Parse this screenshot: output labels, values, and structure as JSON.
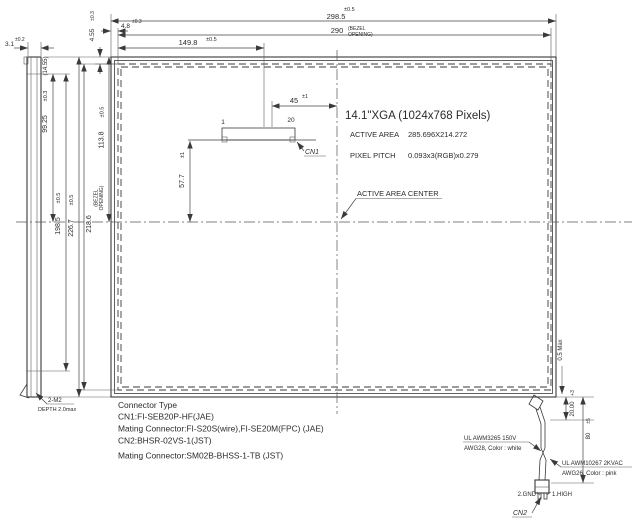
{
  "drawing": {
    "spec": {
      "title": "14.1\"XGA (1024x768 Pixels)",
      "active_area_label": "ACTIVE AREA",
      "active_area_value": "285.696X214.272",
      "pixel_pitch_label": "PIXEL PITCH",
      "pixel_pitch_value": "0.093x3(RGB)x0.279",
      "active_area_center_label": "ACTIVE AREA CENTER"
    },
    "dims": {
      "total_width": {
        "value": "298.5",
        "tol": "±0.5"
      },
      "bezel_width": {
        "value": "290",
        "note1": "(BEZEL",
        "note2": "OPENING)"
      },
      "cn1_offset_x": {
        "value": "149.8",
        "tol": "±0.5"
      },
      "bezel_margin_left": {
        "value": "4.8",
        "tol": "±0.3"
      },
      "bezel_margin_top": {
        "value": "4.55",
        "tol": "±0.3"
      },
      "side_thickness": {
        "value": "3.1",
        "tol": "±0.2"
      },
      "side_thickness_ref": {
        "value": "(14.55)"
      },
      "mount_half_pitch": {
        "value": "99.25",
        "tol": "±0.3"
      },
      "mount_pitch": {
        "value": "198.5",
        "tol": "±0.5"
      },
      "total_height": {
        "value": "226.7",
        "tol": "±0.5"
      },
      "bezel_height": {
        "value": "218.6",
        "note1": "(BEZEL",
        "note2": "OPENING)"
      },
      "center_offset_y": {
        "value": "113.8",
        "tol": "±0.5"
      },
      "cn1_to_center": {
        "value": "45",
        "tol": "±1"
      },
      "cn1_below": {
        "value": "57.7",
        "tol": "±1"
      },
      "edge_gap": {
        "value": "0.5 Max"
      },
      "wire_exit": {
        "value": "20.00",
        "tol": "+3"
      },
      "wire_length": {
        "value": "80",
        "tol": "±5"
      }
    },
    "cn1": {
      "label": "CN1",
      "pin_first": "1",
      "pin_last": "20"
    },
    "cn2": {
      "label": "CN2",
      "pin_gnd": "2.GND",
      "pin_high": "1.HIGH"
    },
    "wires": {
      "white": {
        "line1": "UL AWM3265 150V",
        "line2": "AWG28, Color : white"
      },
      "pink": {
        "line1": "UL AWM10267 2KVAC",
        "line2": "AWG26, Color : pink"
      }
    },
    "mounting": {
      "label": "2-M2",
      "depth": "DEPTH 2.0max"
    },
    "notes": [
      "Connector Type",
      "CN1:FI-SEB20P-HF(JAE)",
      "Mating Connector:FI-S20S(wire),FI-SE20M(FPC) (JAE)",
      "CN2:BHSR-02VS-1(JST)",
      "Mating Connector:SM02B-BHSS-1-TB (JST)"
    ]
  }
}
